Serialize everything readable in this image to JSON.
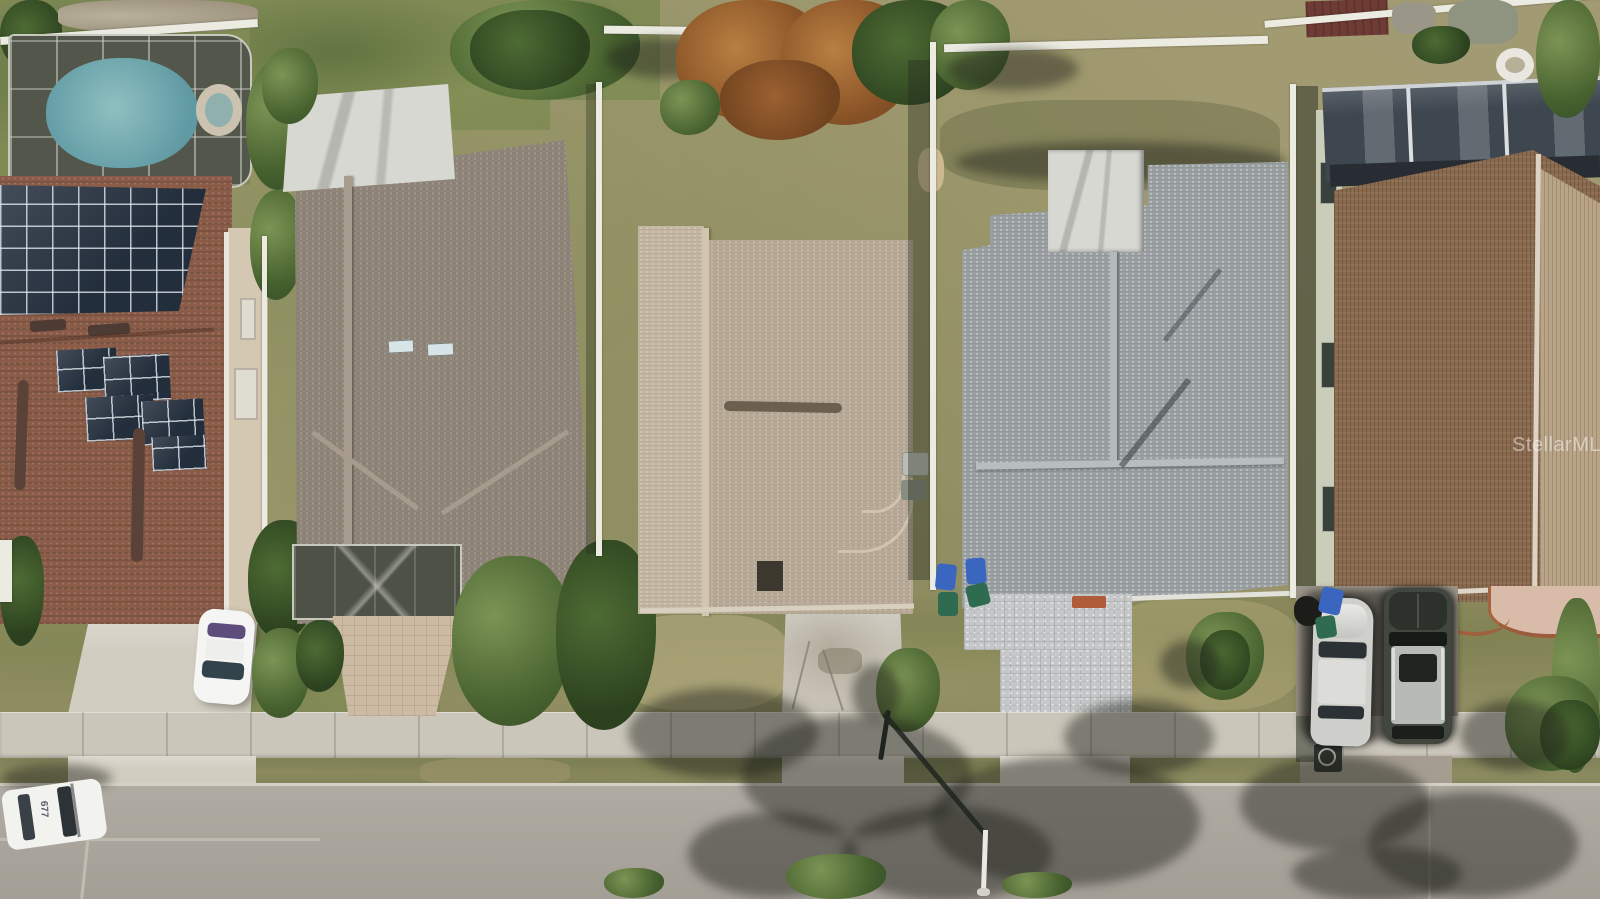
{
  "watermark": {
    "text": "StellarMLS"
  },
  "police_car": {
    "roof_number": "677"
  },
  "palette": {
    "street": "#b0aba2",
    "sidewalk": "#cbc6ba",
    "verge": "#82835a",
    "grassDry": "#a29b74",
    "grassGreen": "#7f8a55",
    "poolWater": "#5f99a3",
    "cage": "#53564b",
    "roofTerra": "#8a5c48",
    "roofTaupe": "#8e8478",
    "roofTan": "#b7a996",
    "roofTanLight": "#c3b6a2",
    "roofGray": "#9aa0a2",
    "roofBrown": "#8a6a4e",
    "roofBrownLight": "#b9a487",
    "metalRoof": "#3e4750",
    "solar": "#232e3c",
    "fence": "#ecebe2",
    "flatWhite": "#d8d8d2",
    "concrete": "#d2cdc1",
    "paversTan": "#ccbaa3",
    "paversGray": "#c5c7c8",
    "sageWall": "#c9cdb9",
    "binBlue": "#3a66c0",
    "binGreen": "#2e6b50",
    "carWhite": "#f5f5f3",
    "carSilver": "#cfd0cc",
    "suvDark": "#41463f",
    "matOrange": "#b05c38"
  },
  "scene": {
    "type": "aerial-photo",
    "subject": "overhead drone view of a residential street with five homes, listing photo",
    "objects": [
      "screened-pool-enclosure",
      "spa",
      "solar-panel-array",
      "terracotta-roof-house",
      "taupe-roof-house",
      "tan-roof-house",
      "gray-roof-house",
      "brown-roof-house",
      "white-sedan",
      "police-car",
      "silver-sedan",
      "dark-suv",
      "trash-bins",
      "paver-driveway",
      "concrete-driveway",
      "white-vinyl-fence",
      "street-light-pole",
      "street-light-shadow",
      "sidewalk",
      "street",
      "tree-shadows"
    ]
  }
}
